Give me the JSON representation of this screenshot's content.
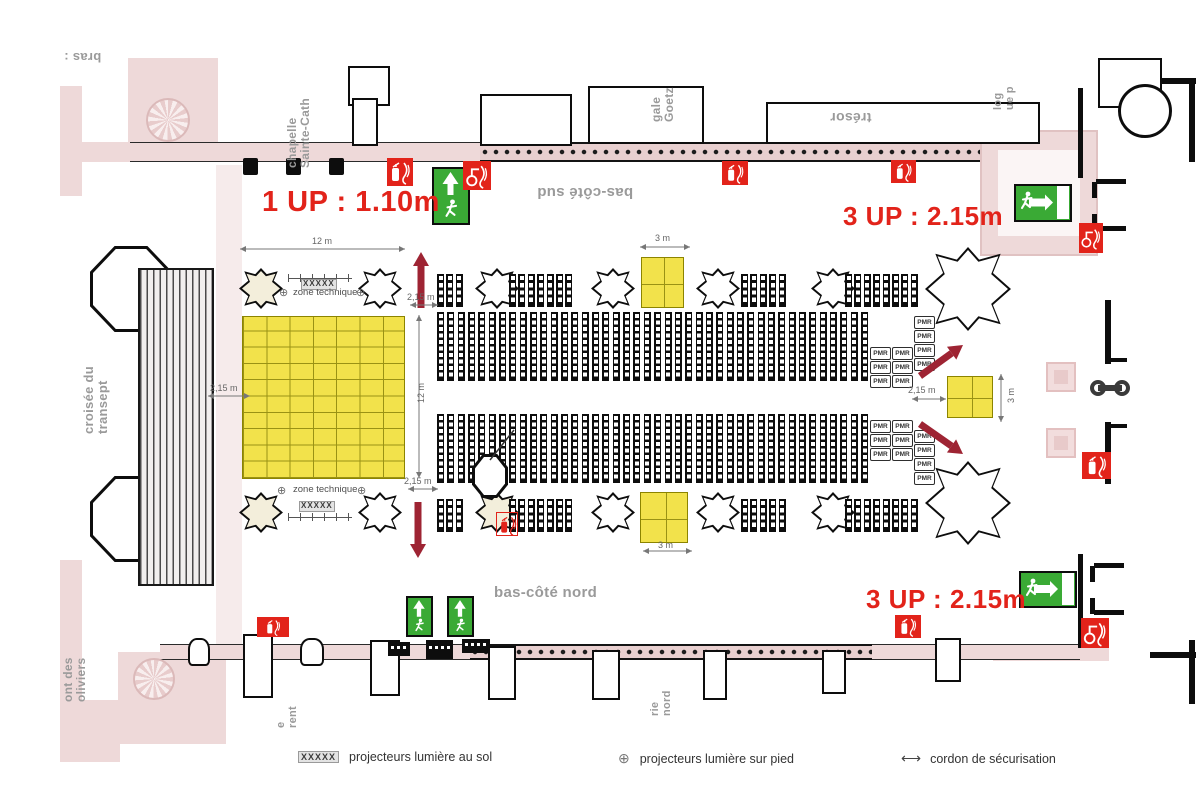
{
  "colors": {
    "red_note": "#e2231a",
    "arrow": "#9e2433",
    "exit_green": "#3aaa35",
    "ext_red": "#e2231a",
    "stage_yellow": "#f2e24b",
    "pink": "#eed9d9",
    "seat": "#0d0d0d",
    "label_gray": "#9a9a9a",
    "dim_gray": "#666666"
  },
  "red_notes": [
    {
      "text": "1 UP : 1.10m",
      "x": 262,
      "y": 186,
      "size": 29
    },
    {
      "text": "3 UP : 2.15m",
      "x": 843,
      "y": 201,
      "size": 26
    },
    {
      "text": "3 UP : 2.15m",
      "x": 866,
      "y": 584,
      "size": 26
    }
  ],
  "place_labels": [
    {
      "lines": [
        "bras :"
      ],
      "x": 64,
      "y": 50,
      "mode": "flip",
      "size": 13
    },
    {
      "lines": [
        "chapelle",
        "Sainte-Cath"
      ],
      "x": 286,
      "y": 56,
      "mode": "vflip",
      "size": 12,
      "h": 112
    },
    {
      "lines": [
        "trésor"
      ],
      "x": 830,
      "y": 110,
      "mode": "flip",
      "size": 14
    },
    {
      "lines": [
        "gale",
        "Goetz"
      ],
      "x": 650,
      "y": 56,
      "mode": "vflip",
      "size": 12,
      "h": 66
    },
    {
      "lines": [
        "log",
        "ue p"
      ],
      "x": 993,
      "y": 54,
      "mode": "vflip",
      "size": 11,
      "h": 56
    },
    {
      "lines": [
        "bas-côté sud"
      ],
      "x": 537,
      "y": 184,
      "mode": "flip",
      "size": 15
    },
    {
      "lines": [
        "bas-côté nord"
      ],
      "x": 494,
      "y": 585,
      "mode": "none",
      "size": 15
    },
    {
      "lines": [
        "croisée du",
        "transept"
      ],
      "x": 82,
      "y": 328,
      "mode": "vflip",
      "size": 13,
      "h": 106
    },
    {
      "lines": [
        "ont des",
        "oliviers"
      ],
      "x": 62,
      "y": 616,
      "mode": "vflip",
      "size": 12,
      "h": 86
    },
    {
      "lines": [
        "e",
        "rent"
      ],
      "x": 276,
      "y": 682,
      "mode": "vflip",
      "size": 11,
      "h": 46
    },
    {
      "lines": [
        "rie",
        "nord"
      ],
      "x": 650,
      "y": 668,
      "mode": "vflip",
      "size": 11,
      "h": 48
    }
  ],
  "dimensions": [
    {
      "type": "h",
      "x1": 240,
      "y": 249,
      "x2": 405,
      "label": "12 m",
      "lx": 312,
      "ly": 236
    },
    {
      "type": "h",
      "x1": 208,
      "y": 396,
      "x2": 250,
      "label": "2,15 m",
      "lx": 210,
      "ly": 383
    },
    {
      "type": "h",
      "x1": 410,
      "y": 305,
      "x2": 438,
      "label": "2,15 m",
      "lx": 407,
      "ly": 292
    },
    {
      "type": "h",
      "x1": 408,
      "y": 489,
      "x2": 438,
      "label": "2,15 m",
      "lx": 404,
      "ly": 476
    },
    {
      "type": "v",
      "x": 419,
      "y1": 315,
      "y2": 478,
      "label": "12 m",
      "lx": 416,
      "ly": 383
    },
    {
      "type": "h",
      "x1": 912,
      "y": 399,
      "x2": 946,
      "label": "2,15 m",
      "lx": 908,
      "ly": 385
    },
    {
      "type": "h",
      "x1": 640,
      "y": 247,
      "x2": 690,
      "label": "3 m",
      "lx": 655,
      "ly": 233
    },
    {
      "type": "h",
      "x1": 643,
      "y": 551,
      "x2": 692,
      "label": "3 m",
      "lx": 658,
      "ly": 540
    },
    {
      "type": "v",
      "x": 1001,
      "y1": 374,
      "y2": 422,
      "label": "3 m",
      "lx": 1006,
      "ly": 388
    }
  ],
  "zone": {
    "technique_label": "zone technique",
    "xxxxx": "XXXXX",
    "plus": "⊕",
    "sets": [
      {
        "tick": [
          288,
          274,
          64
        ],
        "xxxxx": [
          301,
          279
        ],
        "label": [
          293,
          287
        ],
        "plus": [
          [
            279,
            288
          ],
          [
            356,
            288
          ]
        ]
      },
      {
        "label": [
          293,
          484
        ],
        "plus": [
          [
            277,
            486
          ],
          [
            357,
            486
          ]
        ],
        "xxxxx": [
          299,
          501
        ],
        "tick": [
          288,
          513,
          64
        ]
      }
    ]
  },
  "legend": {
    "items": [
      {
        "sym": "XXXXX",
        "label": "projecteurs lumière au sol",
        "x": 298
      },
      {
        "sym": "⊕",
        "label": "projecteurs lumière sur pied",
        "x": 618
      },
      {
        "sym": "⟷",
        "label": "cordon de sécurisation",
        "x": 901
      }
    ],
    "y": 750
  },
  "pmr": {
    "label": "PMR",
    "box_w": 21,
    "box_h": 12.5,
    "gap": 1.5,
    "groups": [
      {
        "x": 870,
        "y": 347,
        "n": 3
      },
      {
        "x": 892,
        "y": 347,
        "n": 3
      },
      {
        "x": 914,
        "y": 316,
        "n": 4
      },
      {
        "x": 870,
        "y": 420,
        "n": 3
      },
      {
        "x": 892,
        "y": 420,
        "n": 3
      },
      {
        "x": 914,
        "y": 430,
        "n": 4
      }
    ]
  },
  "seating": {
    "banks": [
      {
        "x": 437,
        "y": 312,
        "w": 431,
        "h": 69,
        "strips": 42,
        "cells": 10
      },
      {
        "x": 437,
        "y": 414,
        "w": 431,
        "h": 69,
        "strips": 42,
        "cells": 10
      }
    ],
    "aisle_rows": [
      {
        "y": 274,
        "h": 33,
        "groups": [
          {
            "x": 437,
            "n": 3
          },
          {
            "x": 509,
            "n": 7
          },
          {
            "x": 741,
            "n": 5
          },
          {
            "x": 845,
            "n": 8
          }
        ]
      },
      {
        "y": 499,
        "h": 33,
        "groups": [
          {
            "x": 437,
            "n": 3
          },
          {
            "x": 509,
            "n": 7
          },
          {
            "x": 741,
            "n": 5
          },
          {
            "x": 845,
            "n": 8
          }
        ]
      }
    ],
    "strip_w": 7,
    "aisle_step": 9.4
  },
  "stage": {
    "x": 242,
    "y": 316,
    "w": 163,
    "h": 163
  },
  "platforms": [
    [
      641,
      257,
      43,
      51
    ],
    [
      640,
      492,
      48,
      51
    ],
    [
      947,
      376,
      46,
      42
    ]
  ],
  "pulpit": {
    "x": 472,
    "y": 454,
    "w": 36,
    "h": 44,
    "pointer": [
      514,
      430,
      490,
      460
    ]
  },
  "red_arrows": [
    {
      "x1": 421,
      "y1": 308,
      "x2": 421,
      "y2": 252
    },
    {
      "x1": 418,
      "y1": 502,
      "x2": 418,
      "y2": 558
    },
    {
      "x1": 920,
      "y1": 376,
      "x2": 963,
      "y2": 345
    },
    {
      "x1": 920,
      "y1": 424,
      "x2": 963,
      "y2": 454
    }
  ],
  "exits": [
    {
      "t": "v",
      "x": 432,
      "y": 167,
      "w": 38,
      "h": 58
    },
    {
      "t": "h",
      "x": 1014,
      "y": 184,
      "w": 58,
      "h": 38
    },
    {
      "t": "h",
      "x": 1019,
      "y": 571,
      "w": 58,
      "h": 37
    },
    {
      "t": "vs",
      "x": 406,
      "y": 596,
      "w": 27,
      "h": 41
    },
    {
      "t": "vs",
      "x": 447,
      "y": 596,
      "w": 27,
      "h": 41
    }
  ],
  "extinguishers": [
    [
      387,
      158,
      26,
      28,
      "ext"
    ],
    [
      463,
      161,
      28,
      29,
      "hose"
    ],
    [
      722,
      161,
      26,
      24,
      "ext"
    ],
    [
      891,
      160,
      25,
      23,
      "ext"
    ],
    [
      1079,
      223,
      24,
      30,
      "hose"
    ],
    [
      1082,
      452,
      29,
      27,
      "ext"
    ],
    [
      895,
      615,
      26,
      23,
      "ext"
    ],
    [
      1081,
      618,
      28,
      30,
      "hose"
    ],
    [
      257,
      617,
      32,
      20,
      "ext"
    ],
    [
      496,
      512,
      22,
      24,
      "outline"
    ]
  ],
  "door_boxes": [
    [
      388,
      642,
      22,
      14
    ],
    [
      426,
      640,
      27,
      19
    ],
    [
      462,
      639,
      28,
      14
    ]
  ],
  "barbell": {
    "x": 1090,
    "y": 380,
    "r": 8,
    "gap": 24
  },
  "architecture": {
    "pink_blocks": [
      [
        128,
        58,
        90,
        84
      ],
      [
        60,
        86,
        22,
        110
      ],
      [
        60,
        560,
        22,
        146
      ],
      [
        82,
        142,
        50,
        20
      ],
      [
        118,
        652,
        108,
        92
      ],
      [
        60,
        700,
        60,
        62
      ],
      [
        993,
        645,
        116,
        16
      ],
      [
        216,
        165,
        26,
        480,
        "pinklight"
      ]
    ],
    "bands": [
      [
        130,
        142,
        352,
        20
      ],
      [
        868,
        644,
        212,
        16
      ],
      [
        160,
        644,
        312,
        16
      ]
    ],
    "dot_bands": [
      [
        480,
        142,
        596,
        20
      ],
      [
        470,
        644,
        402,
        16
      ]
    ],
    "porch": [
      980,
      130,
      118,
      126
    ],
    "bases": [
      [
        1046,
        362,
        30,
        30
      ],
      [
        1046,
        428,
        30,
        30
      ]
    ],
    "walls": [
      [
        1078,
        88,
        5,
        90
      ],
      [
        1078,
        554,
        5,
        94
      ],
      [
        1092,
        182,
        5,
        16
      ],
      [
        1092,
        214,
        5,
        16
      ],
      [
        1096,
        179,
        30,
        5
      ],
      [
        1096,
        226,
        30,
        5
      ],
      [
        1090,
        566,
        5,
        16
      ],
      [
        1090,
        598,
        5,
        16
      ],
      [
        1094,
        563,
        30,
        5
      ],
      [
        1094,
        610,
        30,
        5
      ],
      [
        1105,
        300,
        6,
        64
      ],
      [
        1105,
        422,
        6,
        62
      ],
      [
        1109,
        358,
        18,
        4
      ],
      [
        1109,
        424,
        18,
        4
      ],
      [
        1150,
        78,
        46,
        6
      ],
      [
        1189,
        78,
        6,
        84
      ],
      [
        1150,
        652,
        46,
        6
      ],
      [
        1189,
        640,
        6,
        64
      ]
    ],
    "chapels": [
      [
        480,
        94,
        92,
        52
      ],
      [
        588,
        86,
        116,
        58
      ],
      [
        766,
        102,
        274,
        42
      ],
      [
        348,
        66,
        42,
        40
      ],
      [
        352,
        98,
        26,
        48
      ],
      [
        1098,
        58,
        64,
        50
      ]
    ],
    "piers_rect": [
      [
        243,
        634,
        30,
        64
      ],
      [
        370,
        640,
        30,
        56
      ],
      [
        488,
        646,
        28,
        54
      ],
      [
        592,
        650,
        28,
        50
      ],
      [
        703,
        650,
        24,
        50
      ],
      [
        822,
        650,
        24,
        44
      ],
      [
        935,
        638,
        26,
        44
      ]
    ],
    "piers_bulb": [
      [
        188,
        638,
        22,
        28
      ],
      [
        300,
        638,
        24,
        28
      ]
    ],
    "top_piers": [
      [
        243,
        158,
        15,
        17
      ],
      [
        286,
        158,
        15,
        17
      ],
      [
        329,
        158,
        15,
        17
      ]
    ],
    "rosettes": [
      [
        146,
        98,
        44
      ],
      [
        133,
        658,
        42
      ]
    ],
    "circle_rooms": [
      [
        1118,
        84,
        54
      ]
    ],
    "octagons": [
      [
        90,
        246,
        82,
        86
      ],
      [
        90,
        476,
        82,
        86
      ]
    ],
    "hatch": [
      [
        138,
        268,
        76,
        318
      ]
    ],
    "pillar_rows": [
      {
        "y": 268,
        "h": 41,
        "cx": [
          261,
          380,
          497,
          613,
          718,
          833
        ],
        "cream": [
          261
        ]
      },
      {
        "y": 492,
        "h": 41,
        "cx": [
          261,
          380,
          497,
          613,
          718,
          833
        ],
        "cream": [
          261,
          497
        ]
      }
    ],
    "big_pillars": [
      [
        925,
        247,
        86,
        84
      ],
      [
        925,
        461,
        86,
        84
      ]
    ],
    "pillar_w": 44
  }
}
